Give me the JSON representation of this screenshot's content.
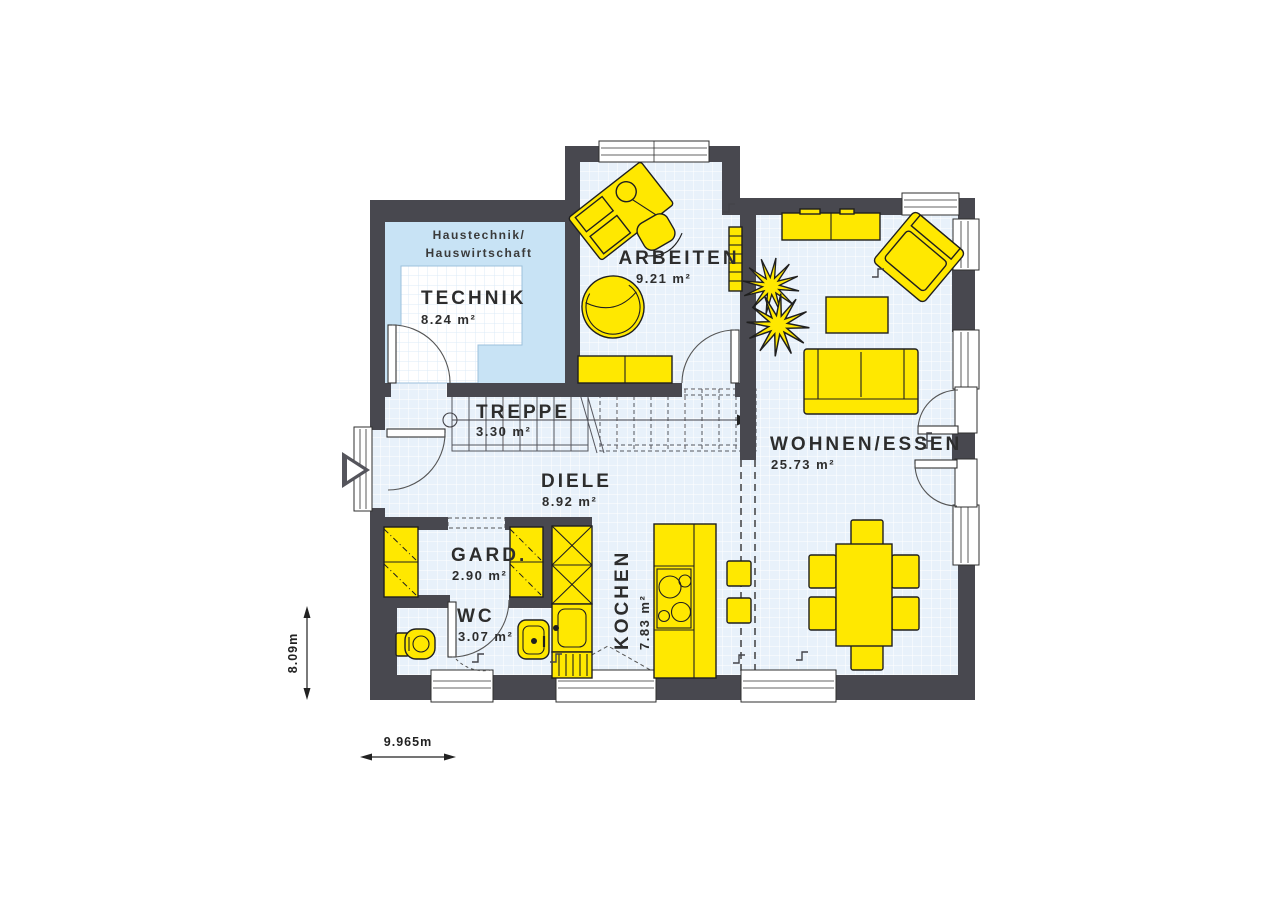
{
  "rooms": {
    "technik": {
      "name": "TECHNIK",
      "area": "8.24 m²"
    },
    "arbeiten": {
      "name": "ARBEITEN",
      "area": "9.21 m²"
    },
    "treppe": {
      "name": "TREPPE",
      "area": "3.30 m²"
    },
    "diele": {
      "name": "DIELE",
      "area": "8.92 m²"
    },
    "gard": {
      "name": "GARD.",
      "area": "2.90 m²"
    },
    "wc": {
      "name": "WC",
      "area": "3.07 m²"
    },
    "kochen": {
      "name": "KOCHEN",
      "area": "7.83 m²"
    },
    "wohnen_essen": {
      "name": "WOHNEN/ESSEN",
      "area": "25.73 m²"
    }
  },
  "annotations": {
    "technik_note_line1": "Haustechnik/",
    "technik_note_line2": "Hauswirtschaft"
  },
  "dimensions": {
    "total_width": "9.965m",
    "total_depth": "8.09m"
  },
  "colors": {
    "wall": "#48484f",
    "furniture": "#ffe800",
    "floor": "#e8f1fa",
    "grid_line": "#ffffff",
    "technik_floor": "#c8e3f5",
    "text": "#2d2d2d"
  }
}
